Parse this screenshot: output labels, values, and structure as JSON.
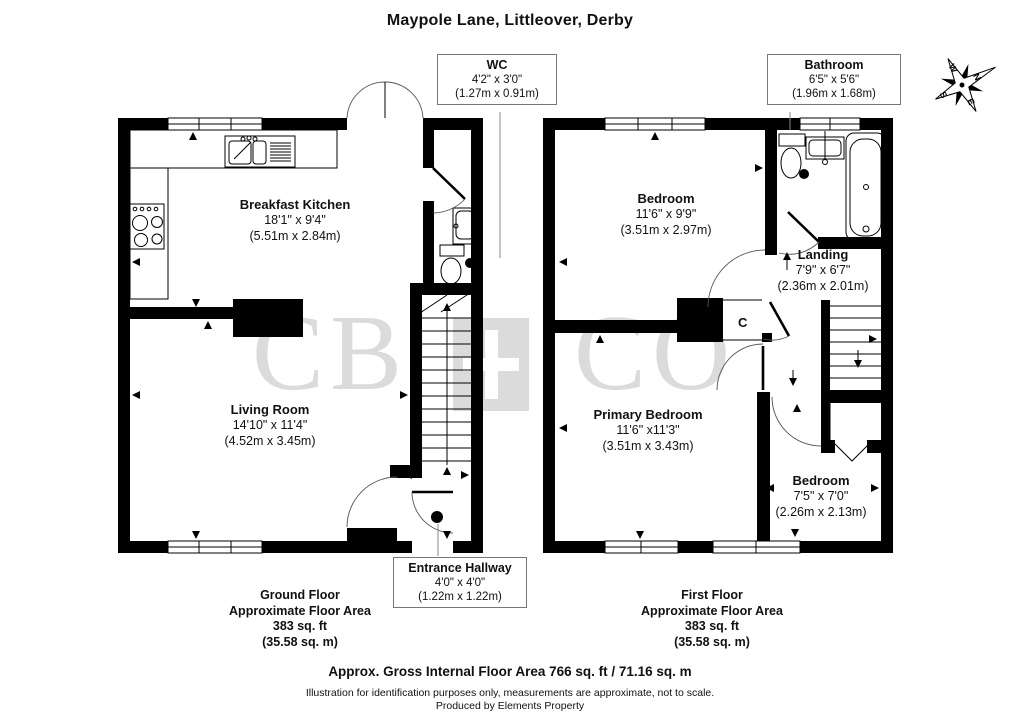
{
  "title": "Maypole Lane, Littleover, Derby",
  "watermark": {
    "left": "CB",
    "right": "CO",
    "color": "#dbdbdb"
  },
  "compass": {
    "n": "N",
    "e": "E",
    "s": "S",
    "w": "W"
  },
  "rooms": {
    "breakfast_kitchen": {
      "name": "Breakfast Kitchen",
      "imperial": "18'1\" x 9'4\"",
      "metric": "(5.51m x 2.84m)"
    },
    "living_room": {
      "name": "Living Room",
      "imperial": "14'10\" x 11'4\"",
      "metric": "(4.52m x 3.45m)"
    },
    "bedroom_one": {
      "name": "Bedroom",
      "imperial": "11'6\" x 9'9\"",
      "metric": "(3.51m x 2.97m)"
    },
    "landing": {
      "name": "Landing",
      "imperial": "7'9\" x 6'7\"",
      "metric": "(2.36m x 2.01m)"
    },
    "primary_bedroom": {
      "name": "Primary Bedroom",
      "imperial": "11'6\" x11'3\"",
      "metric": "(3.51m x 3.43m)"
    },
    "bedroom_two": {
      "name": "Bedroom",
      "imperial": "7'5\" x 7'0\"",
      "metric": "(2.26m x 2.13m)"
    }
  },
  "callouts": {
    "wc": {
      "name": "WC",
      "imperial": "4'2\" x 3'0\"",
      "metric": "(1.27m x 0.91m)"
    },
    "bathroom": {
      "name": "Bathroom",
      "imperial": "6'5\" x 5'6\"",
      "metric": "(1.96m x 1.68m)"
    },
    "entrance_hallway": {
      "name": "Entrance Hallway",
      "imperial": "4'0\" x 4'0\"",
      "metric": "(1.22m x 1.22m)"
    }
  },
  "cupboard_label": "C",
  "floors": {
    "ground": {
      "line1": "Ground Floor",
      "line2": "Approximate Floor Area",
      "line3": "383 sq. ft",
      "line4": "(35.58 sq. m)"
    },
    "first": {
      "line1": "First Floor",
      "line2": "Approximate Floor Area",
      "line3": "383 sq. ft",
      "line4": "(35.58 sq. m)"
    }
  },
  "footer": {
    "total": "Approx. Gross Internal Floor Area 766 sq. ft / 71.16 sq. m",
    "disclaimer": "Illustration for identification purposes only, measurements are approximate, not to scale.",
    "producer": "Produced by Elements Property"
  },
  "colors": {
    "wall": "#000000",
    "watermark": "#dbdbdb",
    "leader": "#8a8a8a"
  }
}
